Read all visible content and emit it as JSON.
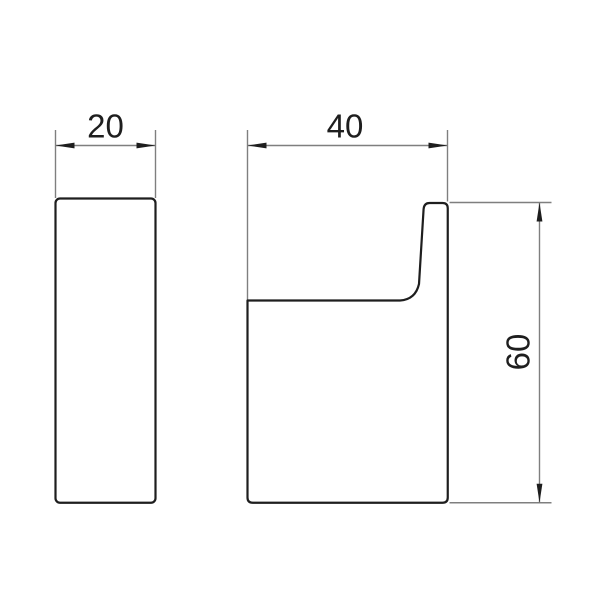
{
  "drawing": {
    "kind": "technical-dimension-drawing",
    "subject": "wall hook, two orthographic views",
    "views": [
      {
        "id": "front-view",
        "description": "front view: tall narrow rounded rectangle"
      },
      {
        "id": "side-view",
        "description": "side profile: block with upward hook tip on right edge"
      }
    ],
    "dimensions": [
      {
        "id": "front-width",
        "value": "20",
        "orientation": "horizontal",
        "applies_to": "front-view width"
      },
      {
        "id": "side-depth",
        "value": "40",
        "orientation": "horizontal",
        "applies_to": "side-view depth"
      },
      {
        "id": "side-height",
        "value": "60",
        "orientation": "vertical",
        "applies_to": "side-view height"
      }
    ],
    "colors": {
      "background": "#ffffff",
      "object_line": "#1e1e1e",
      "dimension_line": "#7f7f7f",
      "text": "#1e1e1e"
    }
  }
}
